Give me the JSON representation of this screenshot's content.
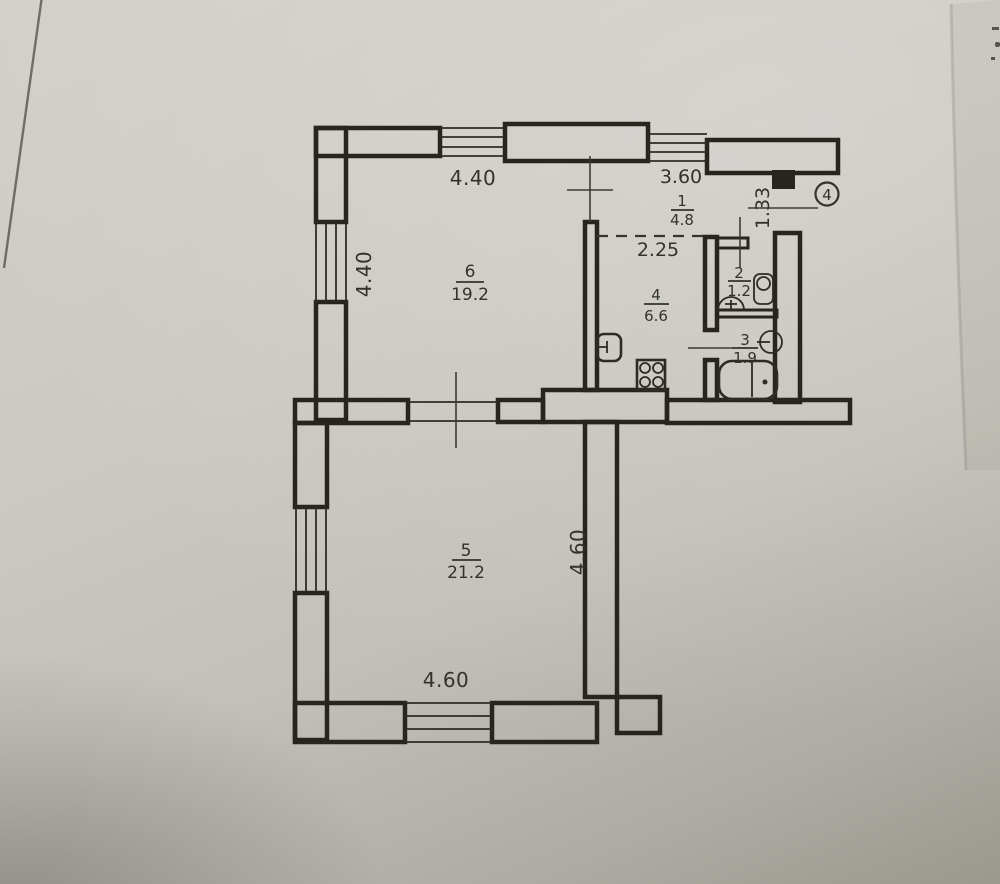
{
  "apartment": {
    "number": "4"
  },
  "rooms": {
    "hall": {
      "number": "1",
      "area": "4.8"
    },
    "bathroom": {
      "number": "2",
      "area": "1.2"
    },
    "toilet": {
      "number": "3",
      "area": "1.9"
    },
    "kitchen": {
      "number": "4",
      "area": "6.6"
    },
    "room5": {
      "number": "5",
      "area": "21.2"
    },
    "room6": {
      "number": "6",
      "area": "19.2"
    }
  },
  "dimensions": {
    "top_left_wall": "4.40",
    "top_right_wall": "3.60",
    "left_wall": "4.40",
    "entrance_door": "1.33",
    "hall_passage": "2.25",
    "room5_bottom_wall": "4.60",
    "room5_right_wall": "4.60"
  }
}
